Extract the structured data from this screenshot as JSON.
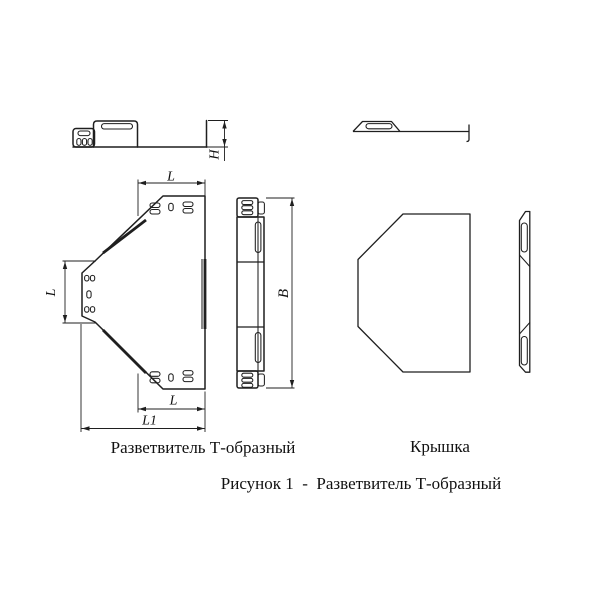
{
  "figure": {
    "caption": "Рисунок 1  -  Разветвитель Т-образный",
    "views": {
      "splitter_label": "Разветвитель Т-образный",
      "cover_label": "Крышка"
    },
    "dimensions": {
      "top_width": "L",
      "branch_width": "L",
      "bottom_width": "L",
      "overall_width": "L1",
      "length": "B",
      "height": "H"
    },
    "colors": {
      "line": "#1f1f1f",
      "text": "#111111",
      "background": "#ffffff"
    }
  }
}
